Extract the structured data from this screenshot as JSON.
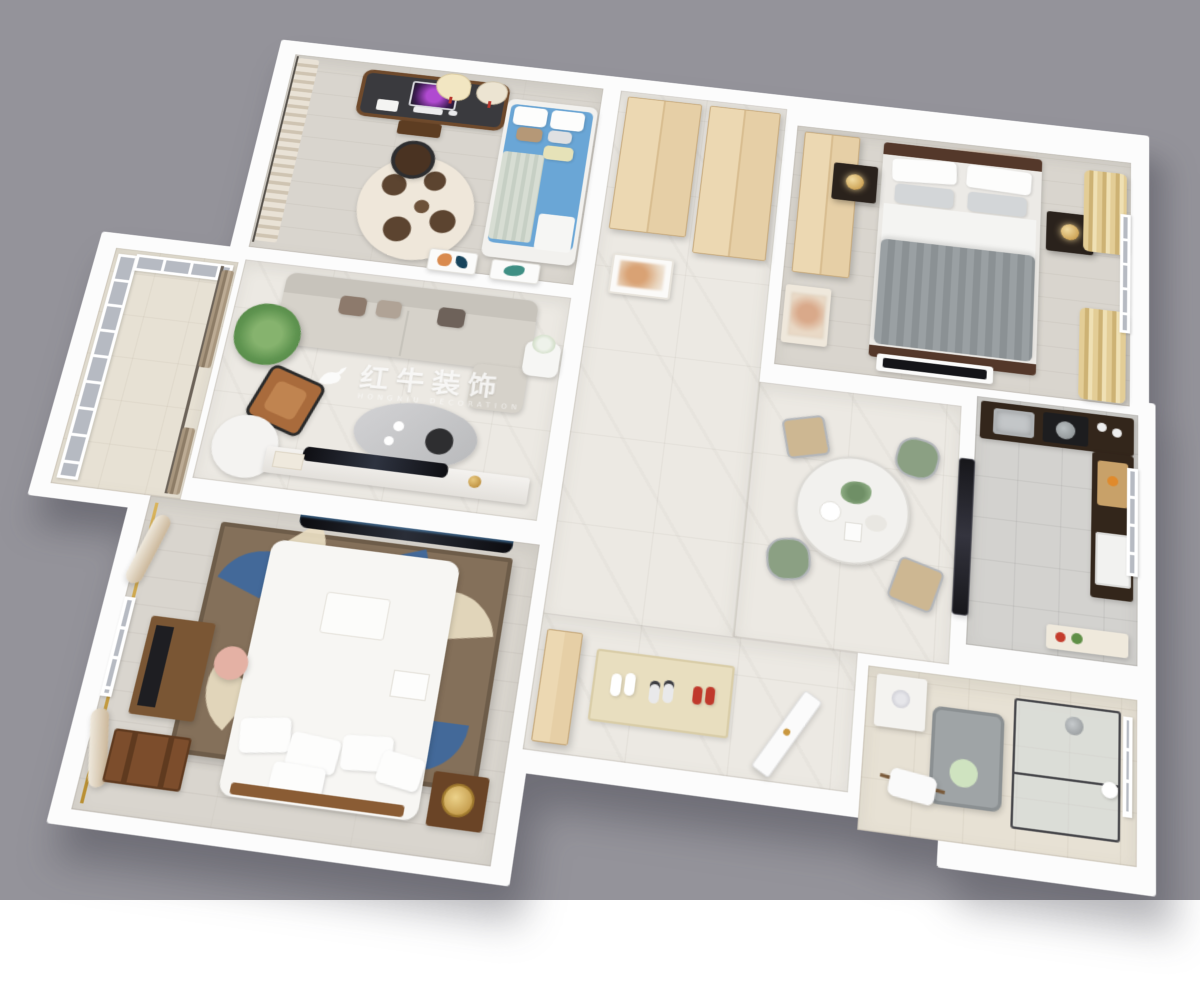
{
  "scene": {
    "description": "3D top-down dollhouse render of a fully furnished two-bedroom apartment floor plan",
    "background_color": "#94939a",
    "wall_color": "#fcfcfc"
  },
  "watermark": {
    "logo": "bull-logo",
    "text": "红牛装饰",
    "subtext": "HONGNIU DECORATION",
    "color": "#ffffff"
  },
  "palette": {
    "wood_floor": "#d9d5ce",
    "marble_floor": "#ece9e3",
    "kitchen_counter": "#33261b",
    "study_bed_blue": "#6aa6d6",
    "sofa_greige": "#d6d2ca",
    "duvet_gray": "#9aa0a3",
    "rug_brown": "#84705a",
    "rug_fan_blue": "#3e689e",
    "wardrobe_wood": "#e6cfa6",
    "leather_caramel": "#a96b3c",
    "dining_chair_green": "#8ba083",
    "dining_chair_rattan": "#cdb792",
    "accent_gold": "#c9973f"
  },
  "rooms": [
    {
      "name": "Study bedroom",
      "furniture": [
        "desk with iMac",
        "office chair",
        "round damask rug",
        "blue single bed",
        "paper-fan wall decor",
        "two leaning canvases",
        "sheer curtains"
      ]
    },
    {
      "name": "Balcony",
      "furniture": [
        "floor-to-ceiling windows",
        "brown curtains"
      ]
    },
    {
      "name": "Living room",
      "furniture": [
        "greige sofa with chaise",
        "potted plant",
        "leather armchair",
        "oval marble coffee table",
        "flower vase",
        "TV console with curved TV",
        "white lounge chair"
      ]
    },
    {
      "name": "Hallway",
      "furniture": [
        "two light-wood wardrobes",
        "framed artwork"
      ]
    },
    {
      "name": "Master bedroom",
      "furniture": [
        "double bed with gray striped duvet",
        "two dark nightstands with gold lamps",
        "wardrobe",
        "dresser with artwork",
        "TV cabinet",
        "gold curtains",
        "window",
        "fish wall art"
      ]
    },
    {
      "name": "Dining area",
      "furniture": [
        "round marble table",
        "two green chairs",
        "two rattan chairs",
        "table plant"
      ]
    },
    {
      "name": "Kitchen",
      "furniture": [
        "L-shaped dark counter",
        "steel sink",
        "cooktop with pot",
        "cutting board",
        "white appliance",
        "black glass sliding door",
        "window"
      ]
    },
    {
      "name": "Bathroom",
      "furniture": [
        "glass shower enclosure",
        "gray bathtub",
        "green basin",
        "white vanity",
        "towel rail with towels",
        "window",
        "toilet paper roll"
      ]
    },
    {
      "name": "Second bedroom",
      "furniture": [
        "white double bed",
        "fan-pattern rug",
        "vanity with mirror",
        "pink stool",
        "leather chest",
        "nightstand with gold clock",
        "wall TV",
        "gold curtain rod with tied drapes",
        "window"
      ]
    },
    {
      "name": "Entry",
      "furniture": [
        "doormat",
        "three pairs of slippers",
        "shoe wardrobe",
        "white front door"
      ]
    }
  ]
}
